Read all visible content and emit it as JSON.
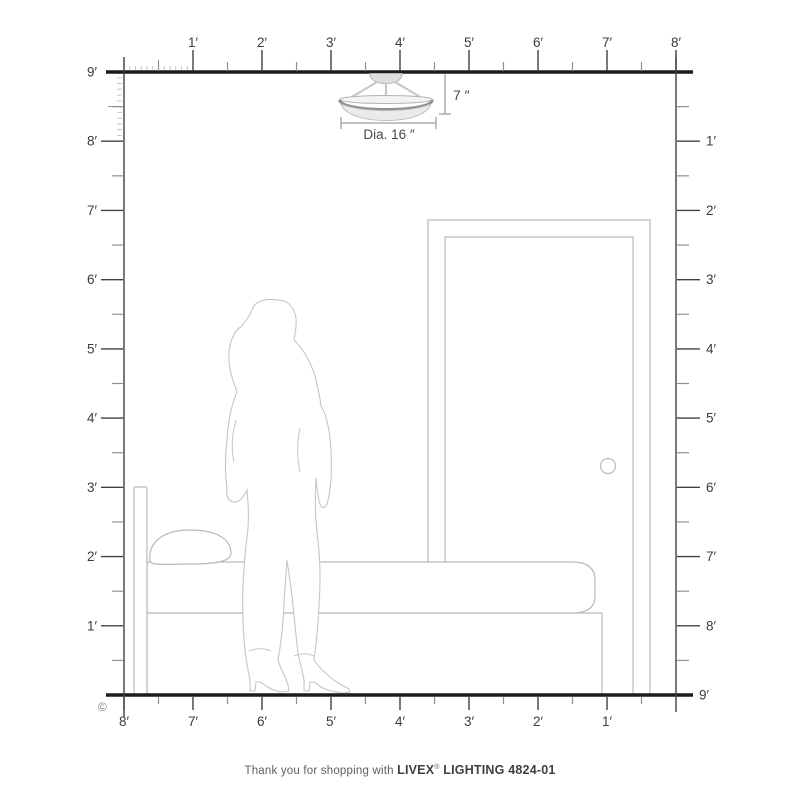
{
  "rulers": {
    "unit": "feet",
    "top": {
      "labels": [
        "1′",
        "2′",
        "3′",
        "4′",
        "5′",
        "6′",
        "7′",
        "8′"
      ]
    },
    "left": {
      "labels": [
        "9′",
        "8′",
        "7′",
        "6′",
        "5′",
        "4′",
        "3′",
        "2′",
        "1′"
      ]
    },
    "right": {
      "labels": [
        "1′",
        "2′",
        "3′",
        "4′",
        "5′",
        "6′",
        "7′",
        "8′"
      ]
    },
    "bottom": {
      "labels": [
        "8′",
        "7′",
        "6′",
        "5′",
        "4′",
        "3′",
        "2′",
        "1′"
      ]
    },
    "floor_right_label": "9′",
    "room_height_label": "9′",
    "room_width_label": "8′"
  },
  "annotations": {
    "fixture_height": "7 ″",
    "fixture_diameter": "Dia. 16 ″",
    "copyright": "©"
  },
  "scene": {
    "objects": [
      "ceiling-light-fixture",
      "woman-silhouette",
      "bed",
      "door"
    ]
  },
  "footer": {
    "prefix": "Thank you for shopping with ",
    "brand": "LIVEX",
    "registered": "®",
    "suffix": " LIGHTING 4824-01"
  },
  "colors": {
    "structure_line": "#1c1c1c",
    "ruler_line": "#3f4040",
    "half_tick": "#8f9193",
    "inch_tick": "#c6c8c9",
    "label_text": "#3b3c3d",
    "furniture_line": "#b6babc",
    "figure_line": "#c3c6c8",
    "dimension_line": "#9ba0a3",
    "dimension_text": "#48494b",
    "footer_text": "#3e3f41",
    "fixture_fill": "#eaebec",
    "fixture_rim": "#8f9294"
  }
}
